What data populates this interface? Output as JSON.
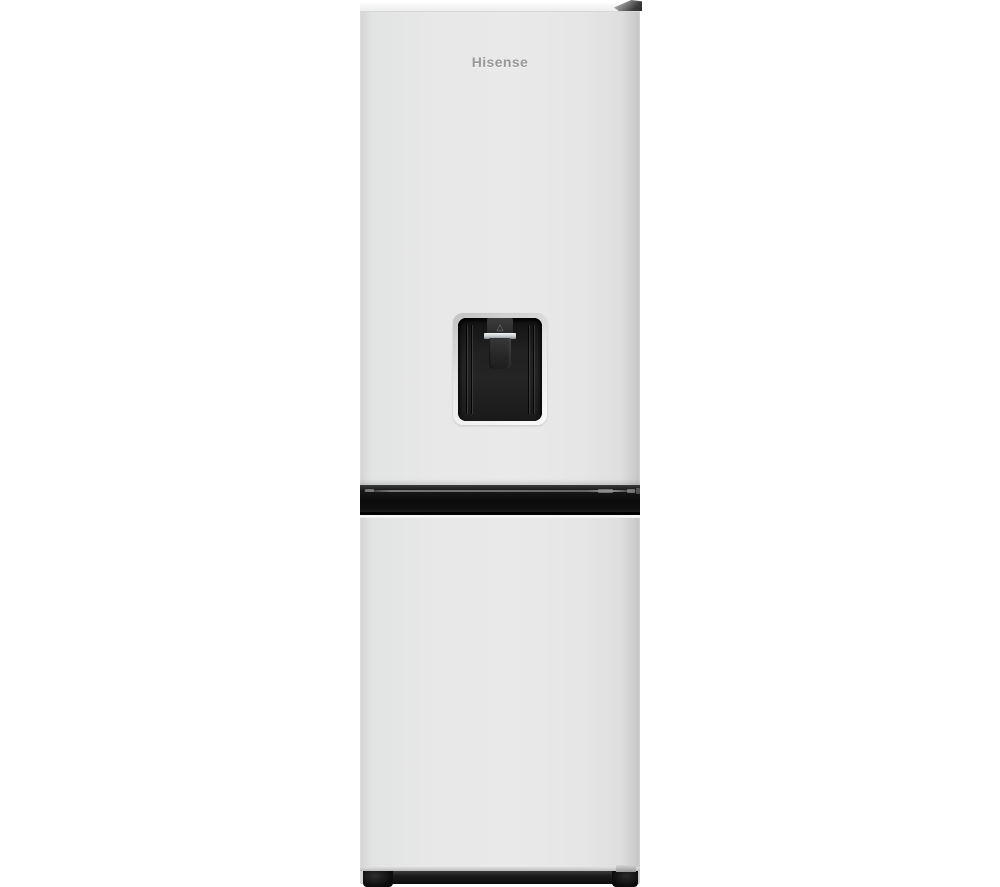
{
  "meta": {
    "description": "Product photo: white fridge-freezer with black water dispenser, front view",
    "background_color": "#ffffff"
  },
  "brand": {
    "logo_text": "Hisense",
    "logo_color": "#97989a"
  },
  "dispenser": {
    "triangle_glyph": "△"
  },
  "colors": {
    "door": "#e8e8e8",
    "door_edge": "#c9c9c9",
    "cabinet_top": "#f2f2f2",
    "band": "#0e0e0e",
    "band_highlight": "#8d8d8d",
    "dispenser_recess": "#1e1e1e",
    "dispenser_bezel": "#dedede",
    "paddle": "#2b2b2b",
    "chrome_trim": "#c6cacc",
    "plinth": "#161616",
    "hinge": "#5a5a5a"
  }
}
